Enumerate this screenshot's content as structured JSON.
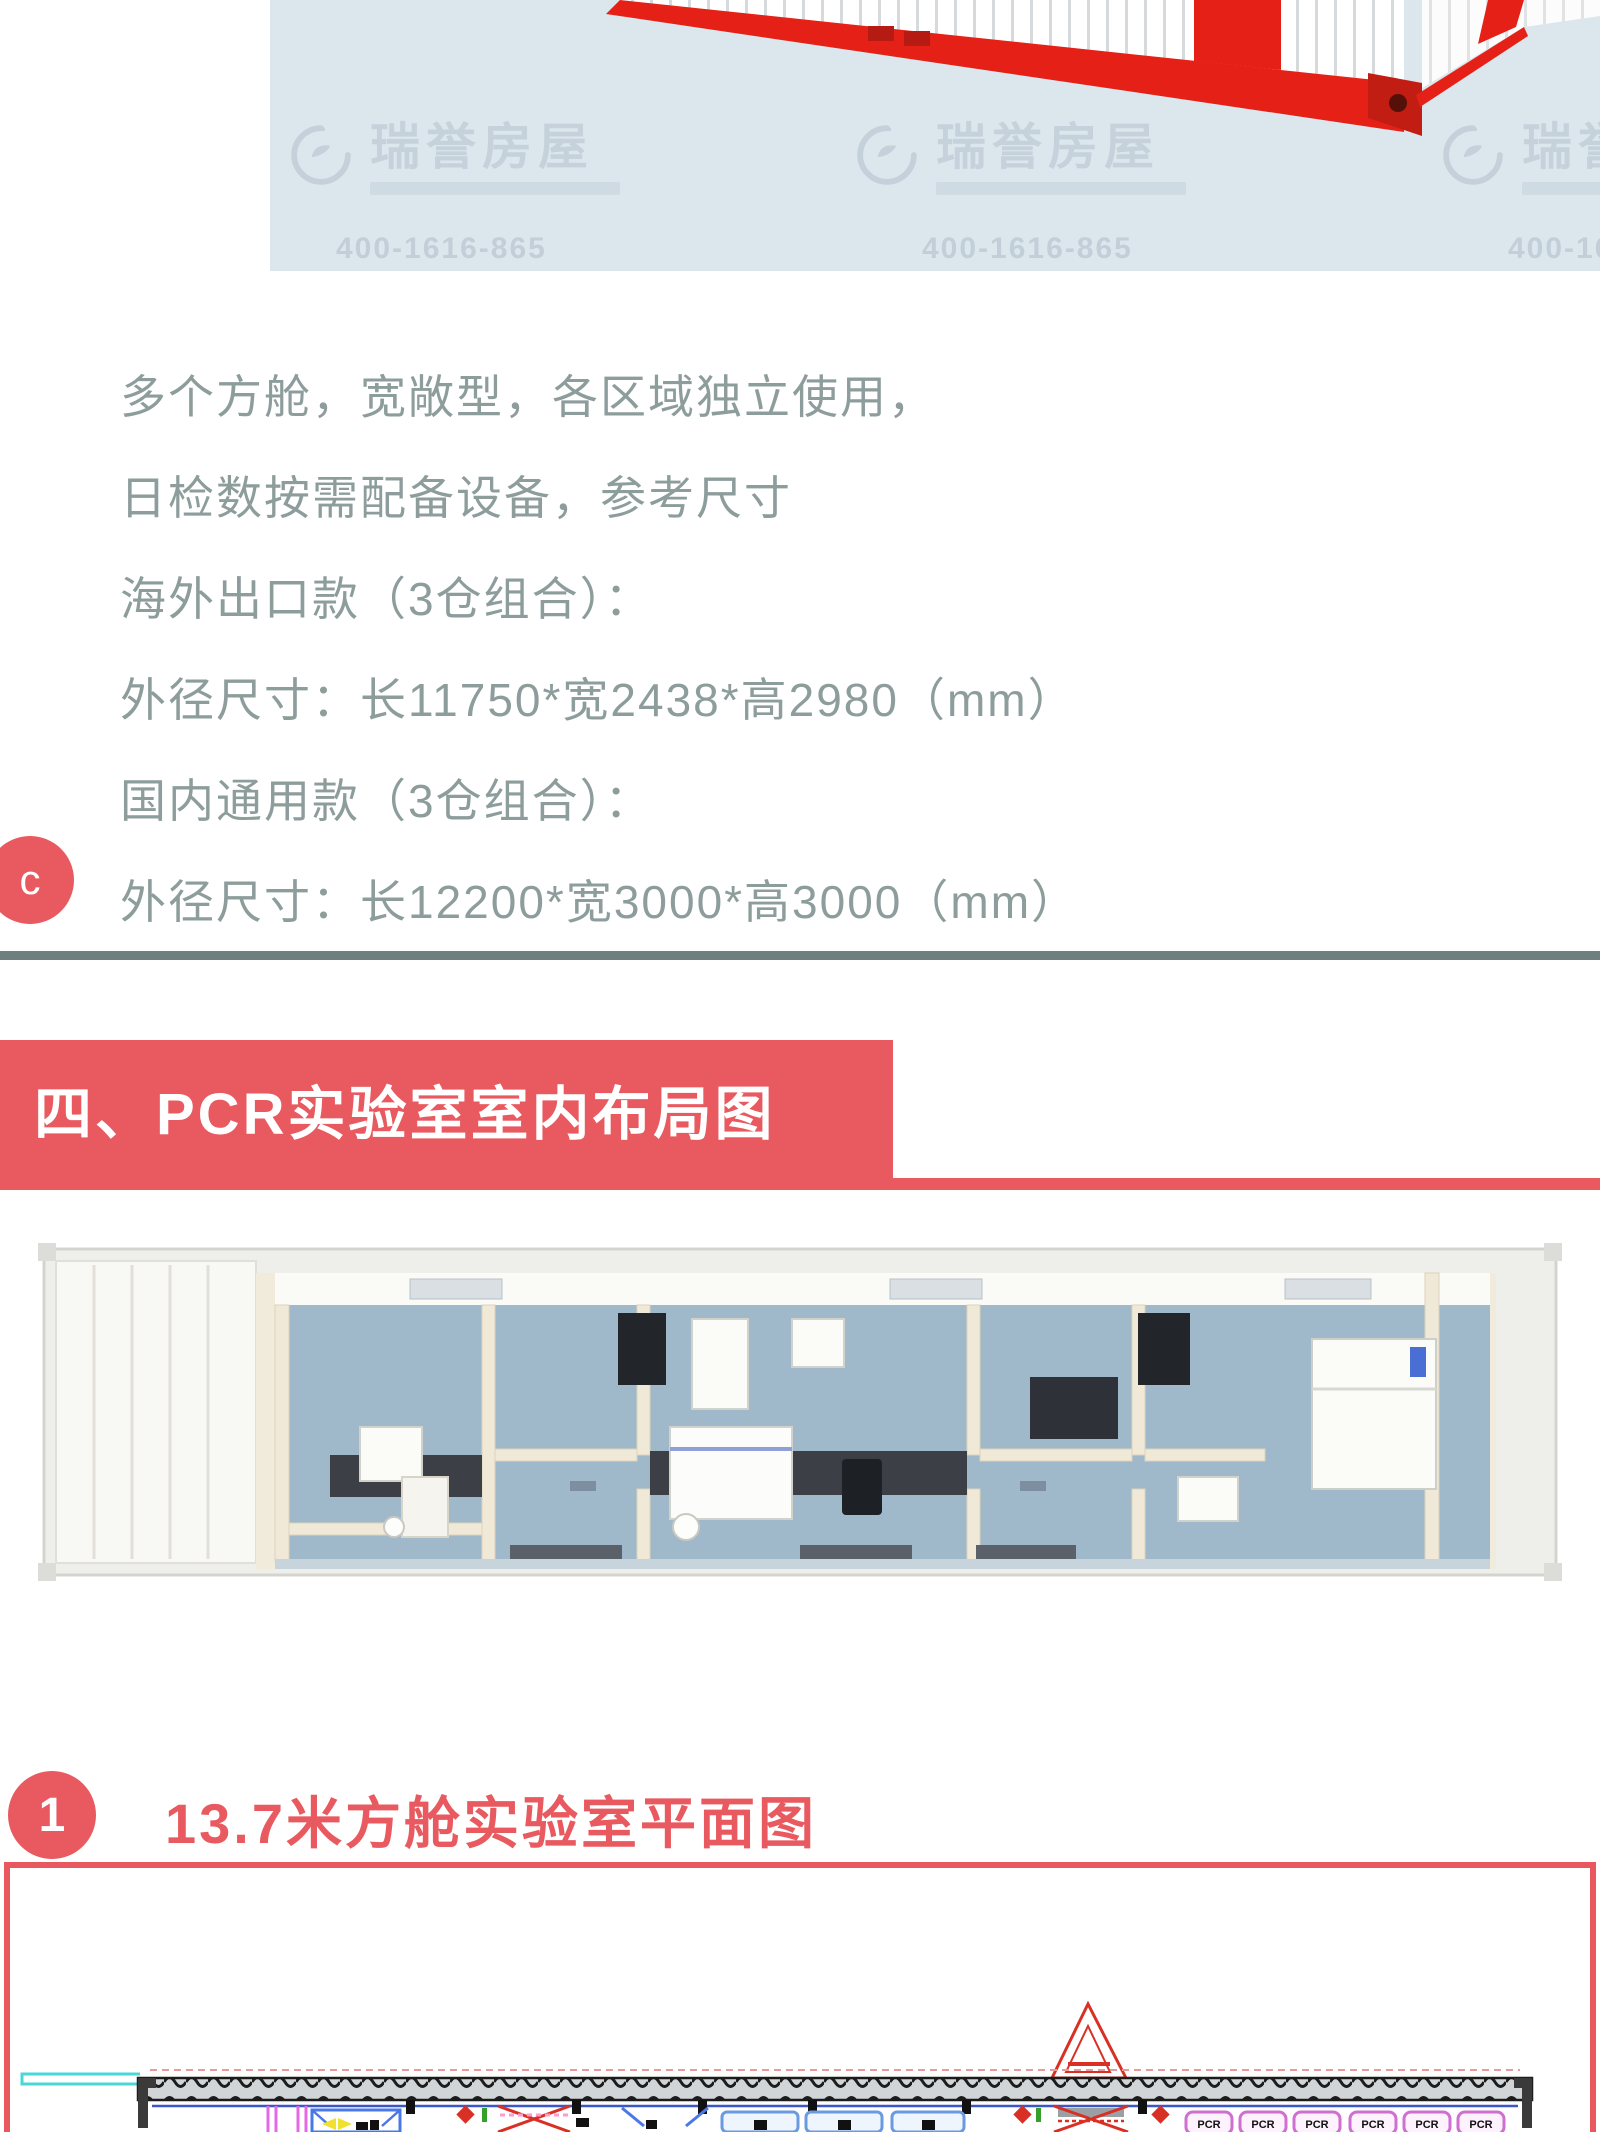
{
  "colors": {
    "accent_red": "#e85a5f",
    "spec_text": "#8d9d9c",
    "hero_background": "#dce6ed",
    "divider": "#6d7f7f"
  },
  "hero": {
    "watermark": {
      "brand": "瑞誉房屋",
      "phone": "400-1616-865"
    }
  },
  "specs": {
    "badge": "c",
    "lines": [
      "多个方舱，宽敞型，各区域独立使用，",
      "日检数按需配备设备，参考尺寸",
      "海外出口款（3仓组合）：",
      "外径尺寸：长11750*宽2438*高2980（mm）",
      "国内通用款（3仓组合）：",
      "外径尺寸：长12200*宽3000*高3000（mm）"
    ]
  },
  "section_banner": {
    "title": "四、PCR实验室室内布局图"
  },
  "subsection": {
    "badge": "1",
    "title": "13.7米方舱实验室平面图"
  },
  "plan": {
    "pcr_labels": [
      "PCR",
      "PCR",
      "PCR",
      "PCR",
      "PCR",
      "PCR"
    ]
  }
}
